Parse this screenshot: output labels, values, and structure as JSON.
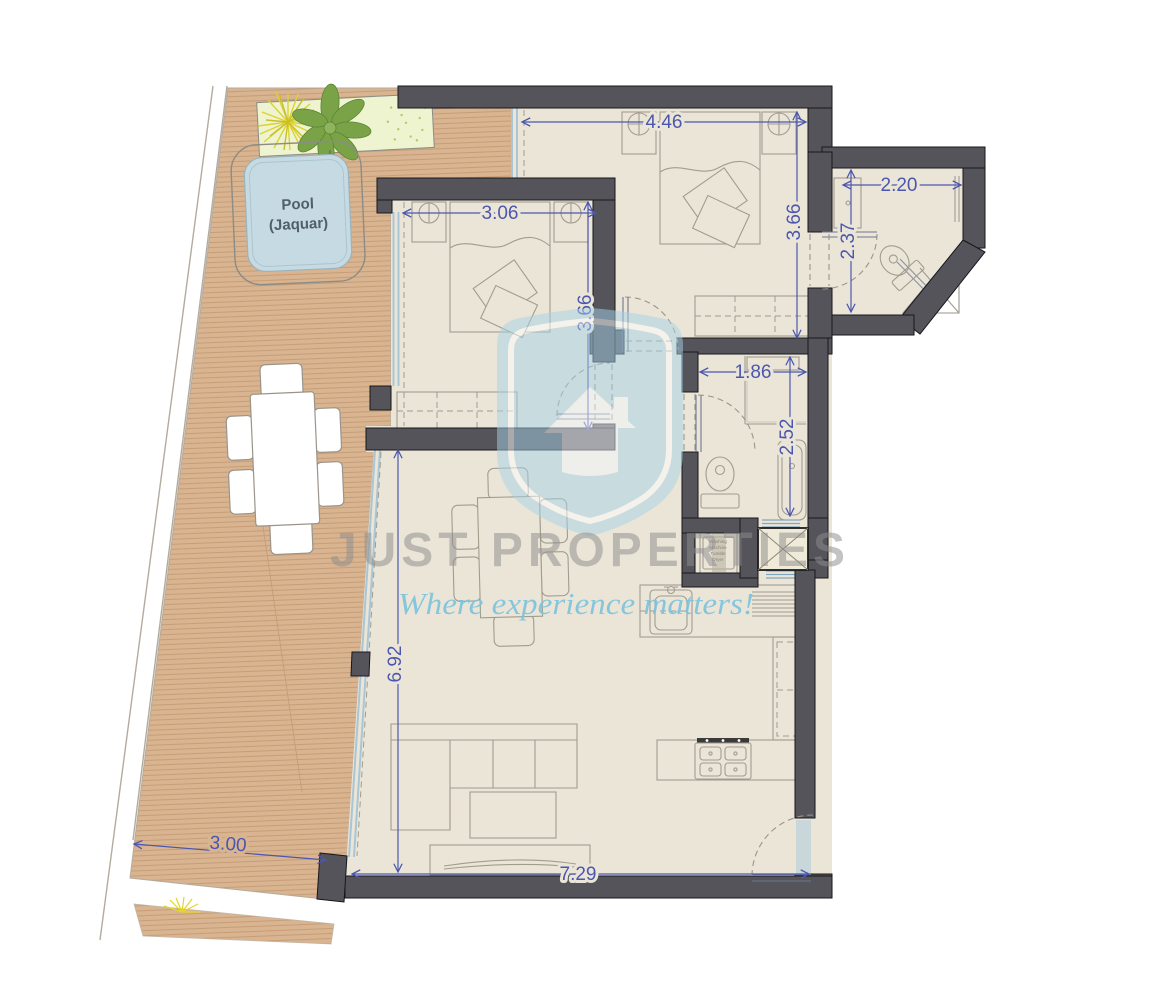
{
  "watermark": {
    "brand": "JUST PROPERTIES",
    "tagline": "Where experience matters!"
  },
  "terrace": {
    "pool_label_line1": "Pool",
    "pool_label_line2": "(Jaquar)",
    "width": "3.00"
  },
  "rooms": {
    "master_bedroom": {
      "width": "4.46",
      "depth": "3.66"
    },
    "bedroom_2": {
      "width": "3.06",
      "depth": "3.66"
    },
    "ensuite_bathroom": {
      "width": "2.20",
      "depth": "2.37"
    },
    "bathroom": {
      "width": "1.86",
      "depth": "2.52"
    },
    "living_dining_kitchen": {
      "width": "7.29",
      "depth": "6.92"
    }
  },
  "laundry": {
    "line1": "Washing",
    "line2": "Machine",
    "line3": "Tumble",
    "line4": "Dryer"
  },
  "colors": {
    "dimension_blue": "#4b57ae",
    "wall_gray": "#55545b",
    "floor_beige": "#ebe5d8",
    "deck_tan": "#d9b491",
    "pool_water": "#c5dae3",
    "watermark_blue": "#a6d2e6",
    "watermark_gray": "#8e8e8e",
    "glass_blue": "#a9c6d6"
  }
}
